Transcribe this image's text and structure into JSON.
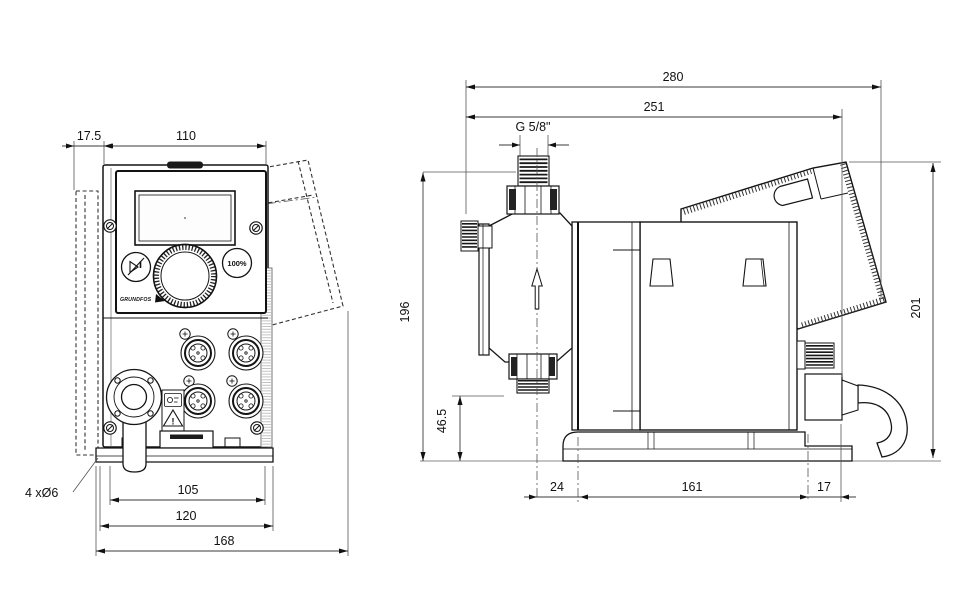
{
  "drawing": {
    "kind": "dosing-pump dimensional drawing, front and side views"
  },
  "front": {
    "dims": {
      "plate_offset": "17.5",
      "body_width": "110",
      "slot_spacing": "105",
      "base_width": "120",
      "overall_width": "168",
      "mount_holes": "4 xØ6"
    },
    "panel": {
      "capacity_button": "100%",
      "brand": "GRUNDFOS",
      "warning_mark": "!"
    }
  },
  "side": {
    "dims": {
      "overall_depth": "280",
      "body_depth": "251",
      "connection_thread": "G 5/8\"",
      "height": "196",
      "suction_height": "46.5",
      "head_offset": "24",
      "base_length": "161",
      "rear_offset": "17",
      "overall_height": "201"
    }
  },
  "icons": {
    "start_stop": "start-stop-play-pause",
    "capacity": "100-percent",
    "flow": "flow-direction-up-arrow",
    "warning": "warning-triangle-exclamation"
  },
  "colors": {
    "line": "#141414",
    "dimension": "#3a3a3a",
    "background": "#ffffff"
  }
}
